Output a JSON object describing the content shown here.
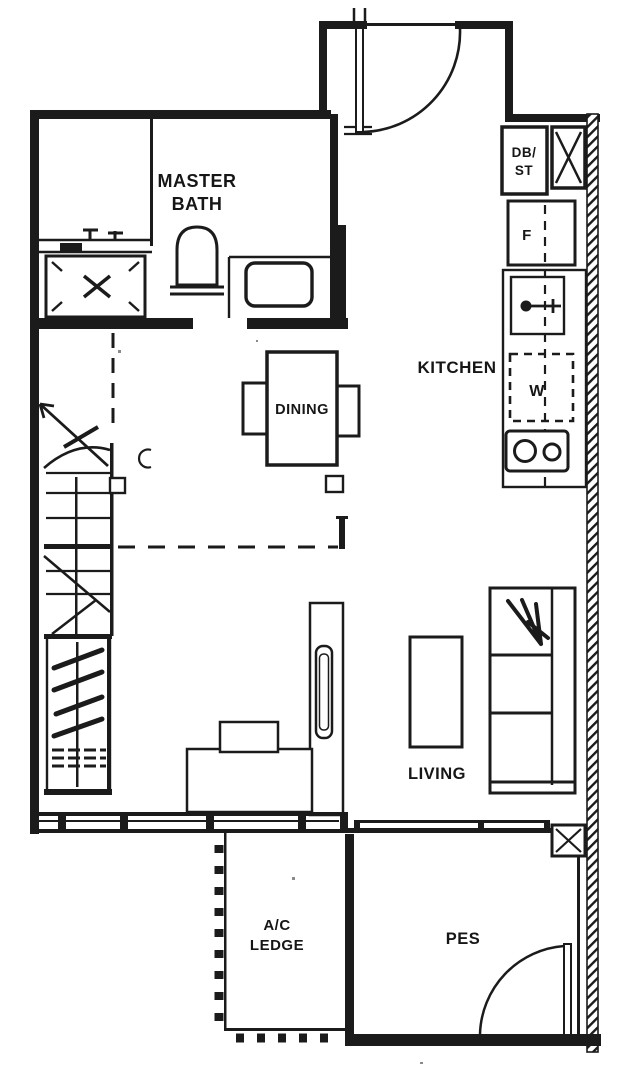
{
  "colors": {
    "ink": "#1b1b1b",
    "paper": "#ffffff"
  },
  "rooms": {
    "master_bath": {
      "label": [
        "MASTER",
        "BATH"
      ]
    },
    "kitchen": {
      "label": "KITCHEN"
    },
    "dining": {
      "label": "DINING"
    },
    "living": {
      "label": "LIVING"
    },
    "ac_ledge": {
      "label": [
        "A/C",
        "LEDGE"
      ]
    },
    "pes": {
      "label": "PES"
    }
  },
  "fixtures": {
    "db_st_cabinet": {
      "label": [
        "DB/",
        "ST"
      ]
    },
    "fridge": {
      "label": "F"
    },
    "washer": {
      "label": "W"
    }
  }
}
